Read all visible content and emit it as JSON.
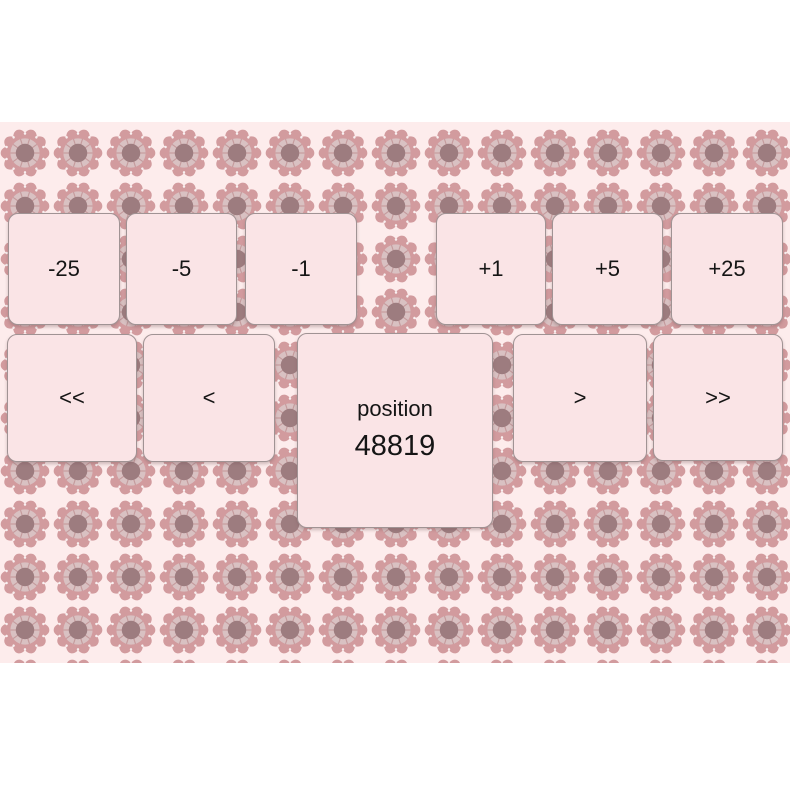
{
  "controls": {
    "step_buttons": [
      {
        "label": "-25"
      },
      {
        "label": "-5"
      },
      {
        "label": "-1"
      },
      {
        "label": "+1"
      },
      {
        "label": "+5"
      },
      {
        "label": "+25"
      }
    ],
    "nav_buttons": [
      {
        "label": "<<"
      },
      {
        "label": "<"
      },
      {
        "label": ">"
      },
      {
        "label": ">>"
      }
    ]
  },
  "position_display": {
    "label": "position",
    "value": "48819"
  },
  "colors": {
    "page_bg": "#ffffff",
    "pattern_bg": "#fdecec",
    "petal": "#d29b9e",
    "petal_inner": "#d9c1c2",
    "petal_line": "#c49a9c",
    "flower_center": "#9d7c7f",
    "petal_dot": "#ffffff",
    "button_bg": "#fae4e6",
    "button_border": "#a09394",
    "text": "#151515"
  }
}
